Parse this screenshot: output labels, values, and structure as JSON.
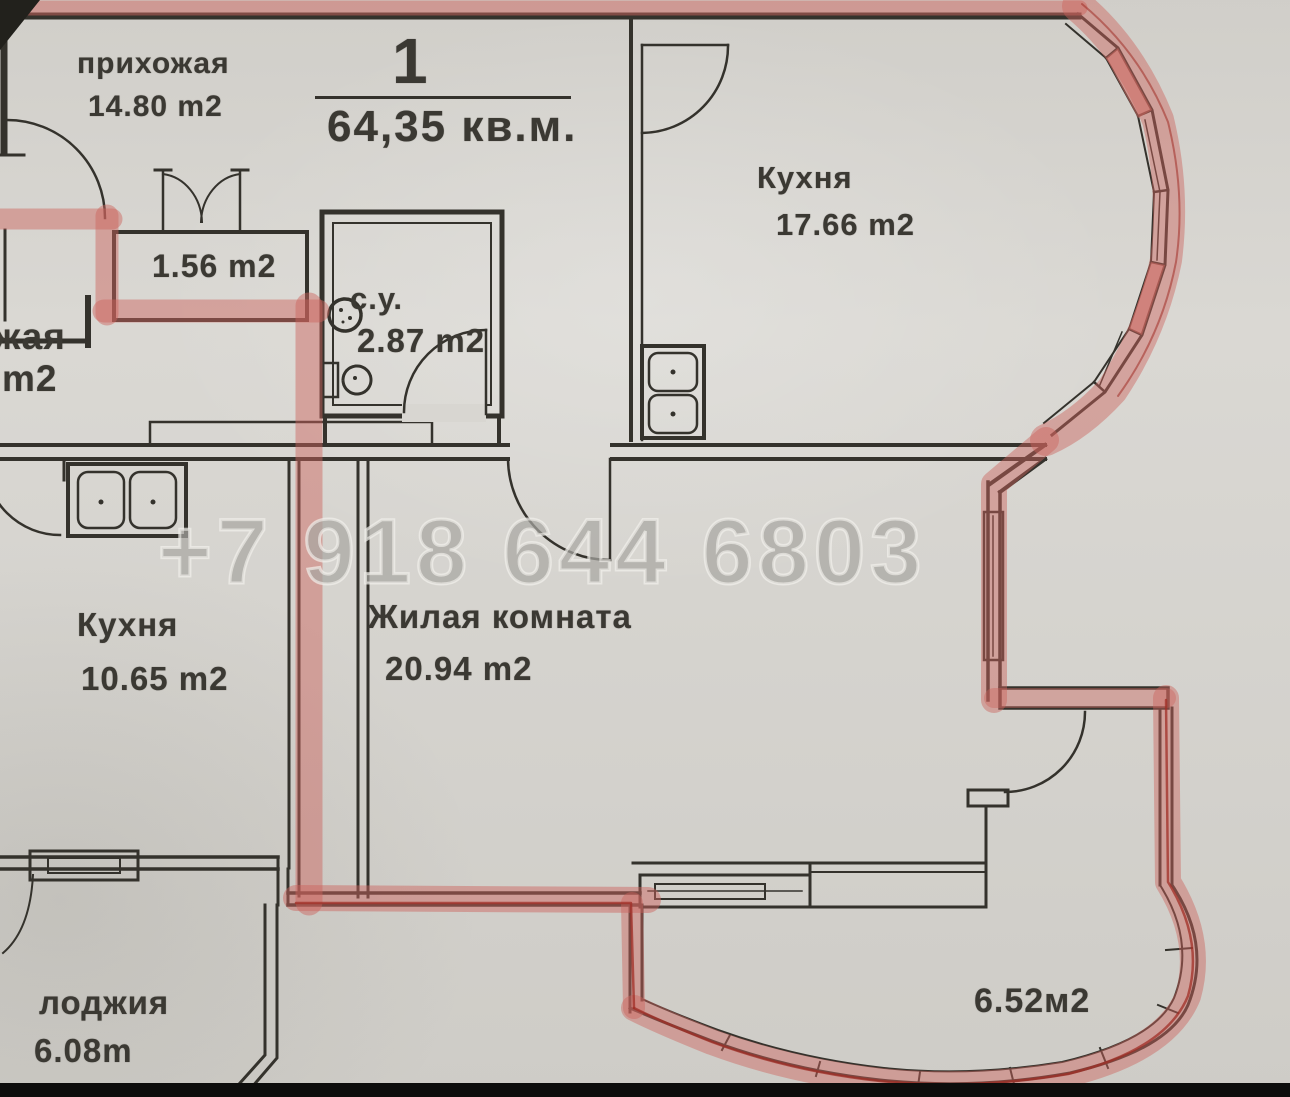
{
  "document": {
    "type": "apartment floor plan (scanned)",
    "unit_number": "1",
    "total_area": "64,35 кв.м."
  },
  "watermark": {
    "phone": "+7 918 644 6803"
  },
  "rooms": {
    "hallway": {
      "name": "прихожая",
      "area": "14.80 m2"
    },
    "kitchen_top": {
      "name": "Кухня",
      "area": "17.66 m2"
    },
    "closet": {
      "area": "1.56 m2"
    },
    "bathroom": {
      "name": "с.у.",
      "area": "2.87 m2"
    },
    "neighbor_cut": {
      "name": "жая",
      "area": "m2"
    },
    "kitchen_left": {
      "name": "Кухня",
      "area": "10.65 m2"
    },
    "living_room": {
      "name": "Жилая комната",
      "area": "20.94 m2"
    },
    "loggia_left": {
      "name": "лоджия",
      "area": "6.08m"
    },
    "balcony_right": {
      "area": "6.52м2"
    }
  },
  "colors": {
    "paper": "#d8d6d1",
    "line": "#34322c",
    "text": "#3b3933",
    "hl": "#cc7a74",
    "hl-dark": "#a23b32",
    "wm": "#8a8883"
  }
}
